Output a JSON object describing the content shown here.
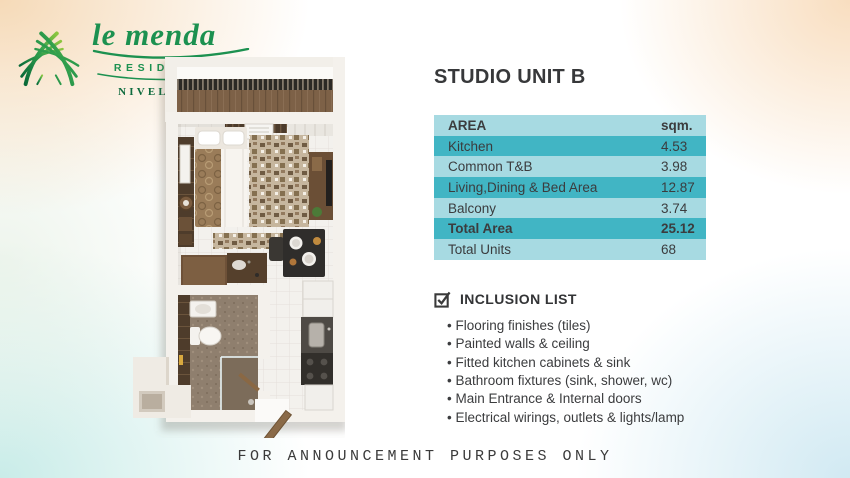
{
  "colors": {
    "teal_dark": "#41b5c4",
    "teal_light": "#a7dae2",
    "brand_green": "#1c9150",
    "brand_green_dark": "#0e6b3e"
  },
  "logo": {
    "brand": "le menda",
    "residences": "RESIDENCES",
    "location": "NIVEL HILLS"
  },
  "unit": {
    "title": "STUDIO UNIT B"
  },
  "area_table": {
    "col_area": "AREA",
    "col_sqm": "sqm.",
    "rows": [
      {
        "label": "Kitchen",
        "value": "4.53",
        "bold": false
      },
      {
        "label": "Common T&B",
        "value": "3.98",
        "bold": false
      },
      {
        "label": "Living,Dining & Bed Area",
        "value": "12.87",
        "bold": false
      },
      {
        "label": "Balcony",
        "value": "3.74",
        "bold": false
      },
      {
        "label": "Total Area",
        "value": "25.12",
        "bold": true
      },
      {
        "label": "Total Units",
        "value": "68",
        "bold": false
      }
    ]
  },
  "inclusion": {
    "title": "INCLUSION LIST",
    "items": [
      "Flooring finishes (tiles)",
      "Painted walls & ceiling",
      "Fitted kitchen cabinets & sink",
      "Bathroom fixtures (sink, shower, wc)",
      "Main Entrance & Internal doors",
      "Electrical wirings, outlets & lights/lamp"
    ]
  },
  "footer": {
    "disclaimer": "FOR ANNOUNCEMENT PURPOSES ONLY"
  }
}
